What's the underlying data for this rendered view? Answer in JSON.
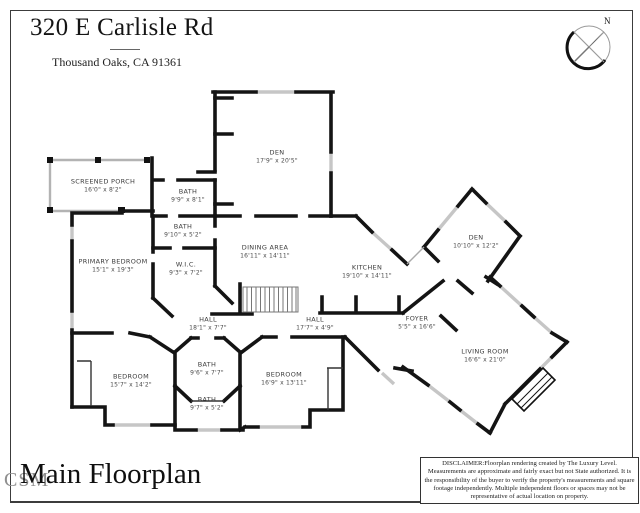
{
  "header": {
    "title": "320 E Carlisle Rd",
    "subtitle": "Thousand Oaks, CA 91361"
  },
  "compass": {
    "label": "N"
  },
  "floorplan": {
    "rooms": [
      {
        "name": "DEN",
        "dims": "17'9\" x 20'5\"",
        "x": 277,
        "y": 157
      },
      {
        "name": "SCREENED PORCH",
        "dims": "16'0\" x 8'2\"",
        "x": 103,
        "y": 186
      },
      {
        "name": "BATH",
        "dims": "9'9\" x 8'1\"",
        "x": 188,
        "y": 196
      },
      {
        "name": "BATH",
        "dims": "9'10\" x 5'2\"",
        "x": 183,
        "y": 231
      },
      {
        "name": "W.I.C.",
        "dims": "9'3\" x 7'2\"",
        "x": 186,
        "y": 269
      },
      {
        "name": "PRIMARY BEDROOM",
        "dims": "15'1\" x 19'3\"",
        "x": 113,
        "y": 266
      },
      {
        "name": "DINING AREA",
        "dims": "16'11\" x 14'11\"",
        "x": 265,
        "y": 252
      },
      {
        "name": "KITCHEN",
        "dims": "19'10\" x 14'11\"",
        "x": 367,
        "y": 272
      },
      {
        "name": "DEN",
        "dims": "10'10\" x 12'2\"",
        "x": 476,
        "y": 242
      },
      {
        "name": "HALL",
        "dims": "18'1\" x 7'7\"",
        "x": 208,
        "y": 324
      },
      {
        "name": "HALL",
        "dims": "17'7\" x 4'9\"",
        "x": 315,
        "y": 324
      },
      {
        "name": "FOYER",
        "dims": "5'5\" x 16'6\"",
        "x": 417,
        "y": 323
      },
      {
        "name": "BEDROOM",
        "dims": "15'7\" x 14'2\"",
        "x": 131,
        "y": 381
      },
      {
        "name": "BATH",
        "dims": "9'6\" x 7'7\"",
        "x": 207,
        "y": 369
      },
      {
        "name": "BATH",
        "dims": "9'7\" x 5'2\"",
        "x": 207,
        "y": 404
      },
      {
        "name": "BEDROOM",
        "dims": "16'9\" x 13'11\"",
        "x": 284,
        "y": 379
      },
      {
        "name": "LIVING ROOM",
        "dims": "16'6\" x 21'0\"",
        "x": 485,
        "y": 356
      }
    ]
  },
  "footer": {
    "plan_title": "Main Floorplan",
    "watermark": "CSM"
  },
  "disclaimer": {
    "text": "DISCLAIMER:Floorplan rendering created by The Luxury Level. Measurements are approximate and fairly exact but not State authorized. It is the responsibility of the buyer to verify the property's measurements and square footage independently.  Multiple independent floors or spaces may not be representative of actual location on property."
  },
  "colors": {
    "wall": "#141414",
    "window": "#c6c6c6",
    "porch_wall": "#b3b3b3",
    "label_text": "#3b3b3b"
  }
}
